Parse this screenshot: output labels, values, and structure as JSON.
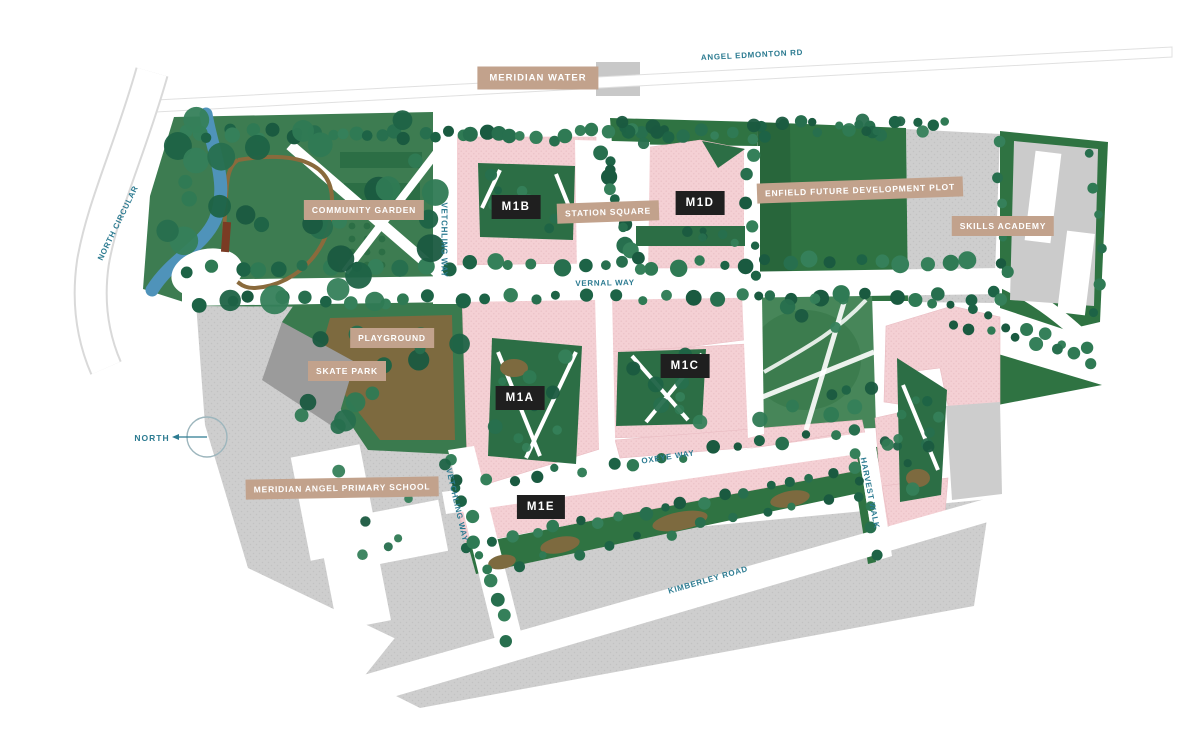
{
  "map_title": "Meridian Water masterplan site map",
  "areas": {
    "meridian_water": "MERIDIAN WATER",
    "community_garden": "COMMUNITY GARDEN",
    "station_square": "STATION SQUARE",
    "enfield_plot": "ENFIELD FUTURE DEVELOPMENT PLOT",
    "skills_academy": "SKILLS ACADEMY",
    "playground": "PLAYGROUND",
    "skate_park": "SKATE PARK",
    "primary_school": "MERIDIAN ANGEL PRIMARY SCHOOL"
  },
  "buildings": {
    "m1a": "M1A",
    "m1b": "M1B",
    "m1c": "M1C",
    "m1d": "M1D",
    "m1e": "M1E"
  },
  "roads": {
    "angel_edmonton": "ANGEL EDMONTON RD",
    "north_circular": "NORTH CIRCULAR",
    "vetchling_way_north": "VETCHLING WAY",
    "vetchling_way_south": "VETCHLING WAY",
    "vernal_way": "VERNAL WAY",
    "oxeye_way": "OXEYE WAY",
    "harvest_walk": "HARVEST WALK",
    "kimberley_road": "KIMBERLEY ROAD"
  },
  "compass": {
    "north_label": "NORTH"
  },
  "colors": {
    "building_pink": "#f3ced2",
    "park_green": "#3d7c51",
    "dense_green": "#2f7342",
    "courtyard_green": "#2c6e45",
    "tree_dark_green": "#1d6346",
    "plot_gray": "#cdcdcd",
    "skate_gray": "#9b9b9b",
    "river_blue": "#4f93ba",
    "playground_brown": "#7d6a3f",
    "label_tan": "#c2a28c",
    "label_black": "#1f1f1f",
    "road_text_teal": "#2c7b91",
    "road_white": "#ffffff"
  }
}
